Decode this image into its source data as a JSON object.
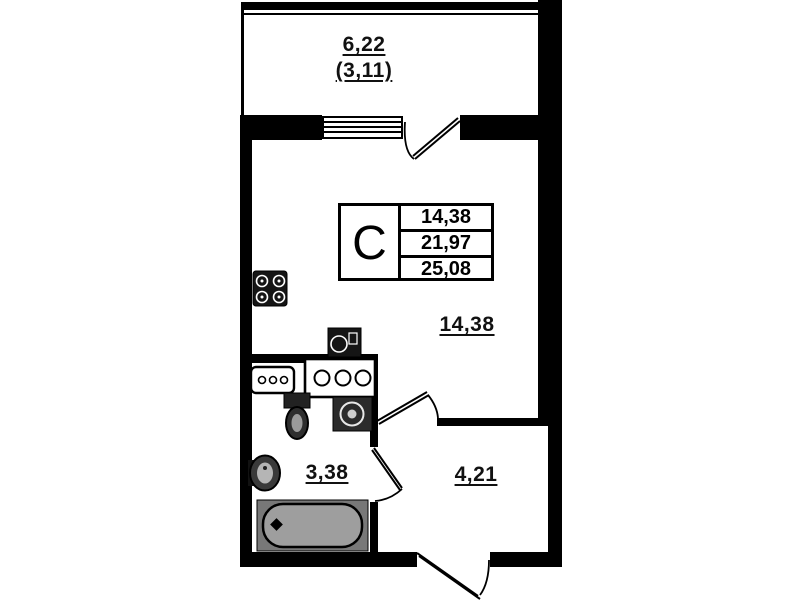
{
  "unit_info": {
    "type_letter": "C",
    "areas": [
      "14,38",
      "21,97",
      "25,08"
    ]
  },
  "room_labels": {
    "balcony_area": "6,22",
    "balcony_area_reduced": "(3,11)",
    "living_area": "14,38",
    "bathroom_area": "3,38",
    "hallway_area": "4,21"
  },
  "fixtures": [
    "stove-icon",
    "kitchen-sink-icon",
    "cabinet-icon",
    "counter-icon",
    "toilet-icon",
    "washing-machine-icon",
    "wash-basin-icon",
    "bathtub-icon",
    "window-icon",
    "balcony-door-icon",
    "room-door-icon",
    "bathroom-door-icon",
    "entrance-door-icon"
  ],
  "colors": {
    "walls": "#000000",
    "background": "#ffffff",
    "bathtub_fill": "#9e9e9e"
  }
}
